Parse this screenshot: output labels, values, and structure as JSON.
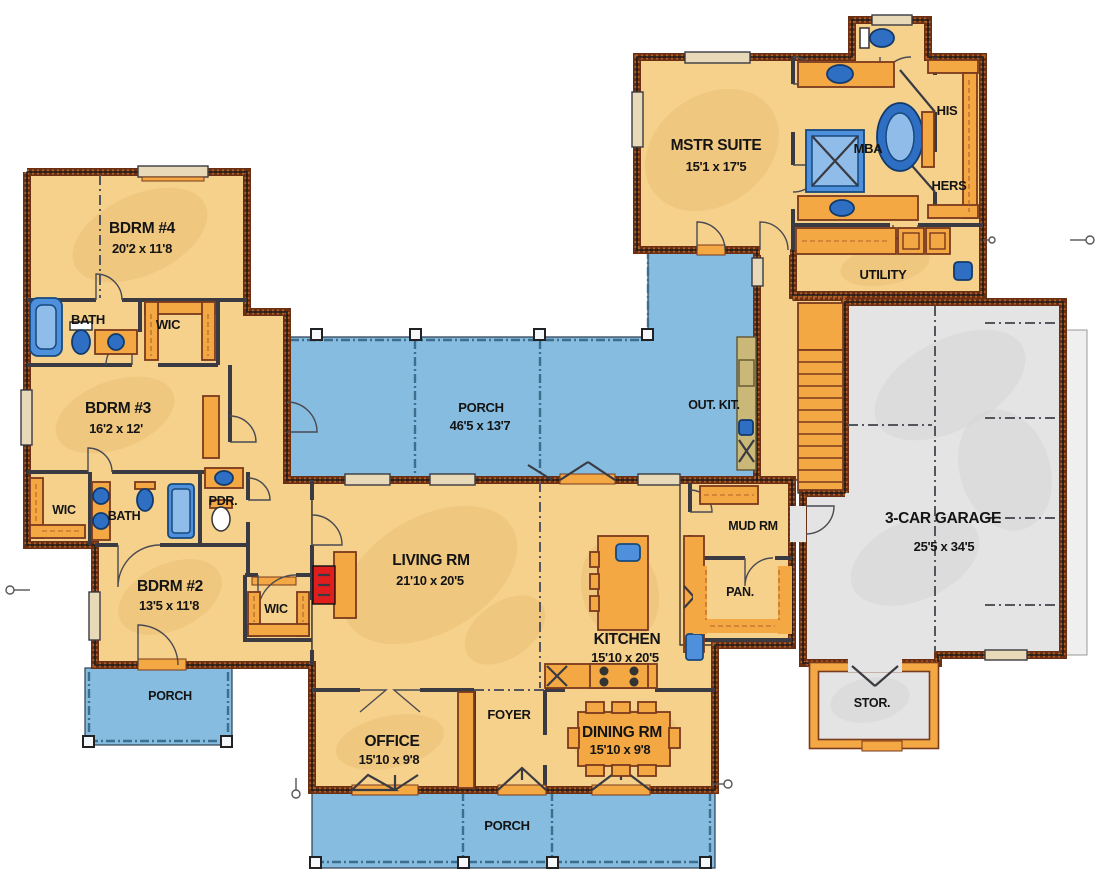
{
  "plan": {
    "type": "floor-plan",
    "colors": {
      "floor_tan": "#F5D18C",
      "porch_blue": "#85BCDF",
      "garage_gray": "#E4E4E4",
      "wall_brown": "#6B2F14",
      "wall_hatch": "#B05F26",
      "cabinet_orange": "#F3A844",
      "fixture_blue": "#4E90DC",
      "outdoor_kitchen_khaki": "#C9B878",
      "fireplace_red": "#E01E1E",
      "label_black": "#141414"
    },
    "rooms": {
      "mstr_suite": {
        "name": "MSTR SUITE",
        "dims": "15'1 x 17'5"
      },
      "mba": {
        "name": "MBA"
      },
      "his": {
        "name": "HIS"
      },
      "hers": {
        "name": "HERS"
      },
      "utility": {
        "name": "UTILITY"
      },
      "garage": {
        "name": "3-CAR GARAGE",
        "dims": "25'5 x 34'5"
      },
      "stor": {
        "name": "STOR."
      },
      "porch_top": {
        "name": "PORCH",
        "dims": "46'5 x 13'7"
      },
      "out_kit": {
        "name": "OUT. KIT."
      },
      "mud_rm": {
        "name": "MUD RM"
      },
      "pan": {
        "name": "PAN."
      },
      "living": {
        "name": "LIVING RM",
        "dims": "21'10 x 20'5"
      },
      "kitchen": {
        "name": "KITCHEN",
        "dims": "15'10 x 20'5"
      },
      "dining": {
        "name": "DINING RM",
        "dims": "15'10 x 9'8"
      },
      "foyer": {
        "name": "FOYER"
      },
      "office": {
        "name": "OFFICE",
        "dims": "15'10 x 9'8"
      },
      "bdrm2": {
        "name": "BDRM #2",
        "dims": "13'5 x 11'8"
      },
      "bdrm3": {
        "name": "BDRM #3",
        "dims": "16'2 x 12'"
      },
      "bdrm4": {
        "name": "BDRM #4",
        "dims": "20'2 x 11'8"
      },
      "bath_upper": {
        "name": "BATH"
      },
      "wic_upper": {
        "name": "WIC"
      },
      "bath_mid": {
        "name": "BATH"
      },
      "wic_mid": {
        "name": "WIC"
      },
      "wic_bdrm2": {
        "name": "WIC"
      },
      "pdr": {
        "name": "PDR."
      },
      "porch_bottom": {
        "name": "PORCH"
      },
      "porch_left": {
        "name": "PORCH"
      }
    }
  }
}
